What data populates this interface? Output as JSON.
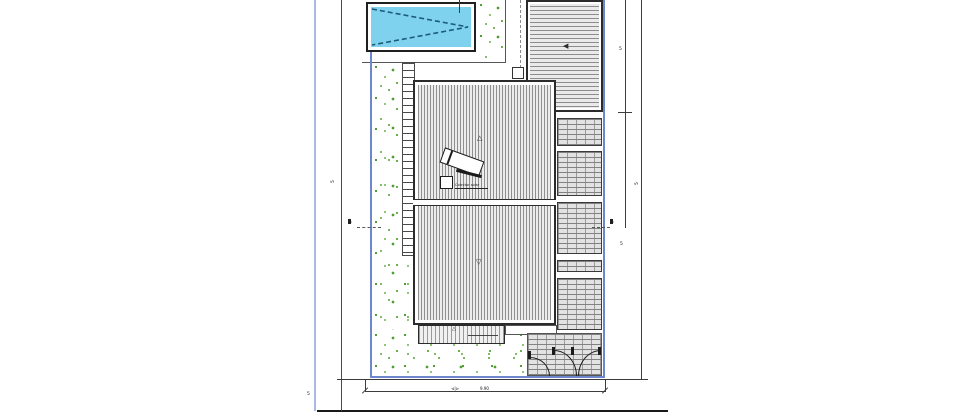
{
  "site_plan": {
    "labels": {
      "solar_collector": "Colector solar"
    },
    "dimension_labels": {
      "left_vertical": "5",
      "left_corner": "5",
      "bottom_marker": "⊲|⊳",
      "bottom_value": "9.90",
      "right_inner_top": "5",
      "right_inner_lower": "5",
      "right_outer": "5"
    },
    "symbols": {
      "roof_slope_up": "△",
      "roof_slope_down": "▽",
      "deck_arrow": "◀",
      "porch_arrow": "△",
      "section_marker": "△"
    },
    "colors": {
      "plot_boundary": "#6d87cc",
      "sheet_guide": "#a9bade",
      "pool_water": "#7ed2ee",
      "pool_dash": "#1d5b7a",
      "garden_dot": "#55a237",
      "hatch_line": "#8f8f8f",
      "ink": "#2b2b2b"
    }
  }
}
